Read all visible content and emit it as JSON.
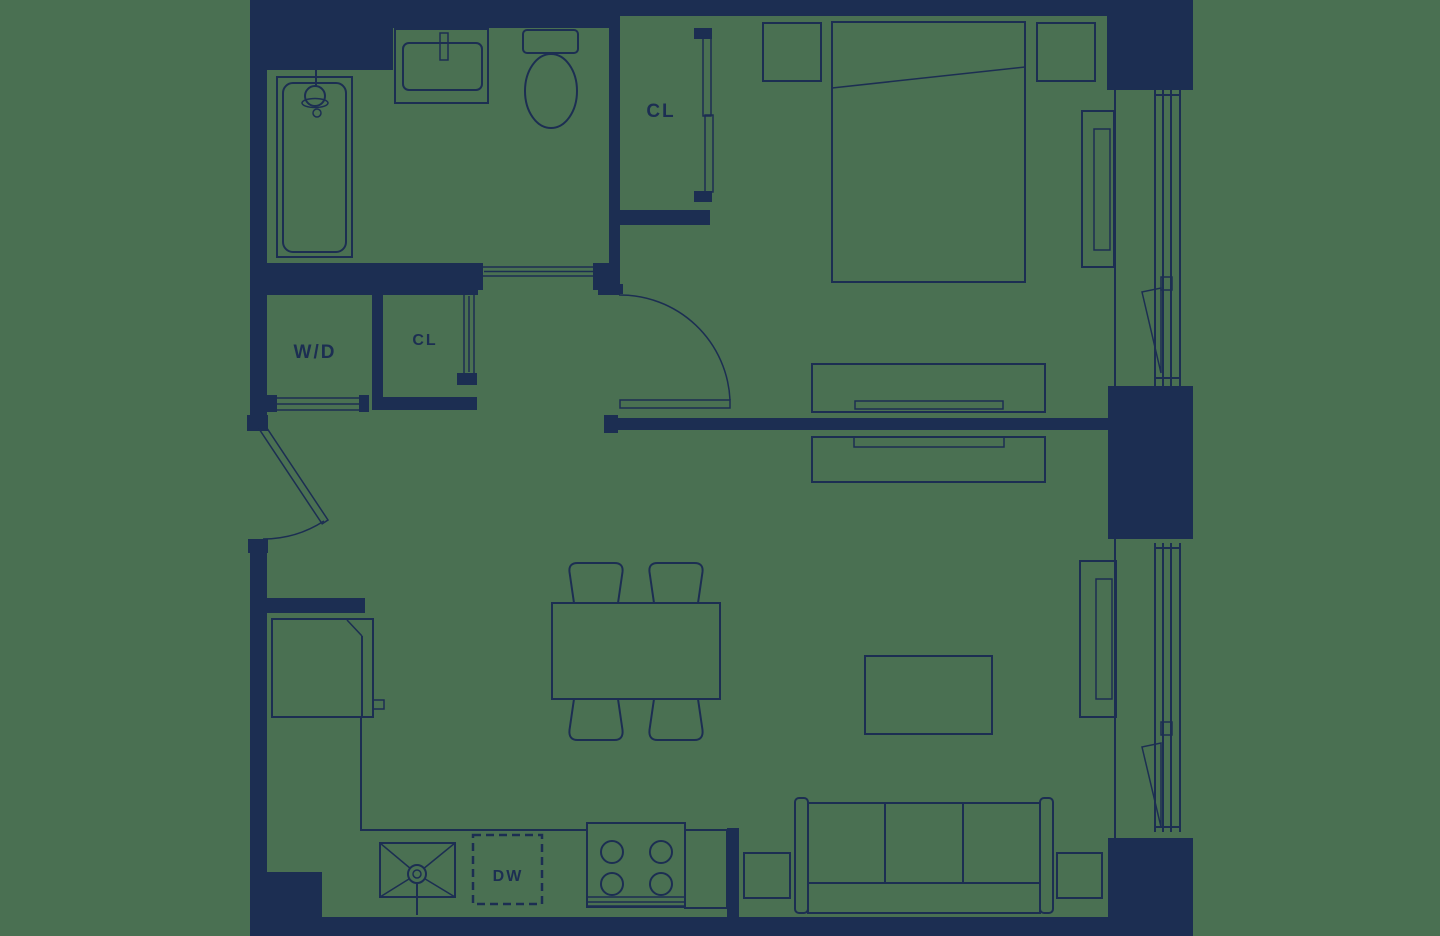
{
  "colors": {
    "background": "#4A7052",
    "ink": "#1C2E52"
  },
  "labels": {
    "bedroom_closet": "CL",
    "washer_dryer": "W/D",
    "hall_closet": "CL",
    "dishwasher": "DW"
  }
}
